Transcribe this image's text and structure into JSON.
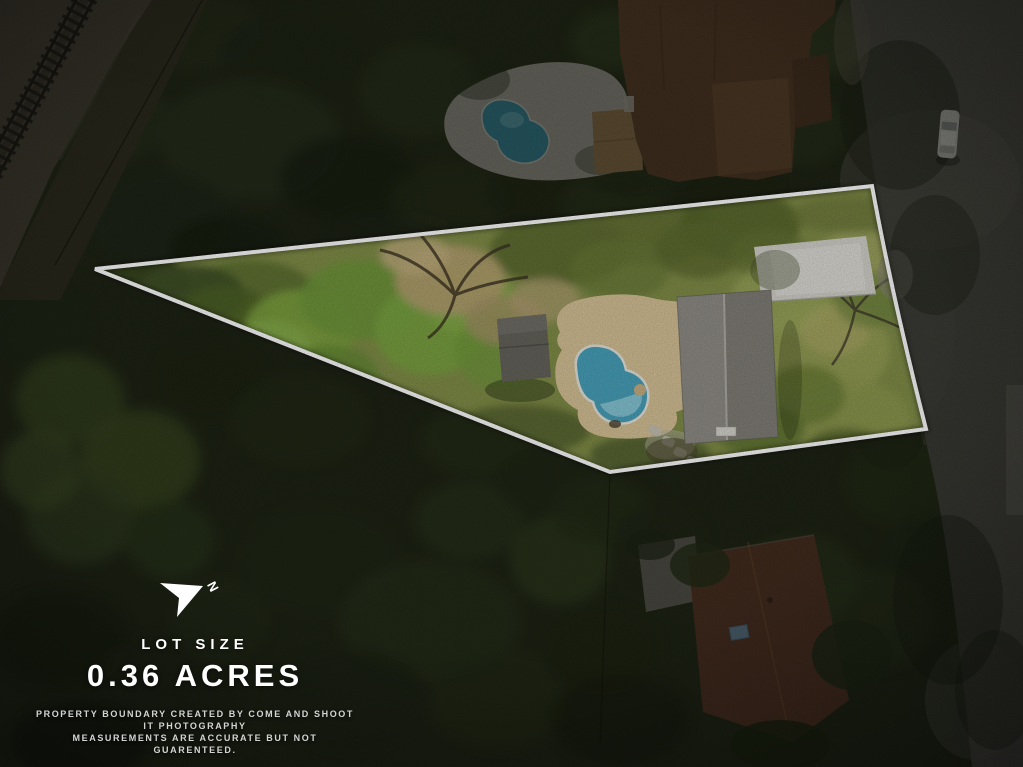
{
  "compass": {
    "letter": "N"
  },
  "lot": {
    "label": "LOT SIZE",
    "value": "0.36 ACRES"
  },
  "disclaimer": {
    "line1": "PROPERTY BOUNDARY CREATED BY COME AND SHOOT IT PHOTOGRAPHY",
    "line2": "MEASUREMENTS ARE ACCURATE BUT NOT GUARENTEED."
  },
  "colors": {
    "boundary_line": "#FFFFFF",
    "overlay_text": "#FFFFFF",
    "lot_pool_water": "#49A2BC",
    "neighbor_pool_water": "#3E96AC",
    "main_roof_gray": "#8A8780",
    "neighbor_roof_brown": "#6B4A31",
    "rear_roof_redbrown": "#6F4530",
    "driveway_concrete": "#D5D3CC",
    "lawn_green": "#828F49",
    "road_asphalt": "#605E58"
  },
  "scene": {
    "description": "Aerial drone photo of a wedge-shaped 0.36 acre lot outlined in white containing a gray-roof house, kidney-shaped pool, shed and concrete driveway; dark forest around, railroad tracks upper left, road along the right with a white vehicle, neighboring houses with pool above and below."
  }
}
